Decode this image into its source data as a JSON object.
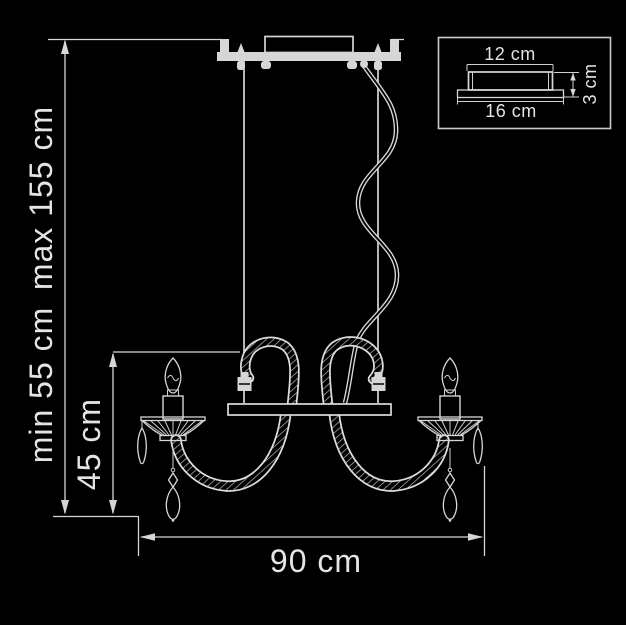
{
  "diagram": {
    "type": "product-dimension-drawing",
    "subject": "two-arm chandelier pendant light",
    "colors": {
      "background": "#000000",
      "line": "#d6d6d6",
      "text": "#e4e4e4"
    },
    "dimensions": {
      "height_max_label": "max 155 cm",
      "height_min_label": "min 55 cm",
      "body_height_label": "45 cm",
      "width_label": "90 cm"
    },
    "inset": {
      "canopy_top_width_label": "12 cm",
      "canopy_base_width_label": "16 cm",
      "canopy_height_label": "3 cm"
    }
  }
}
